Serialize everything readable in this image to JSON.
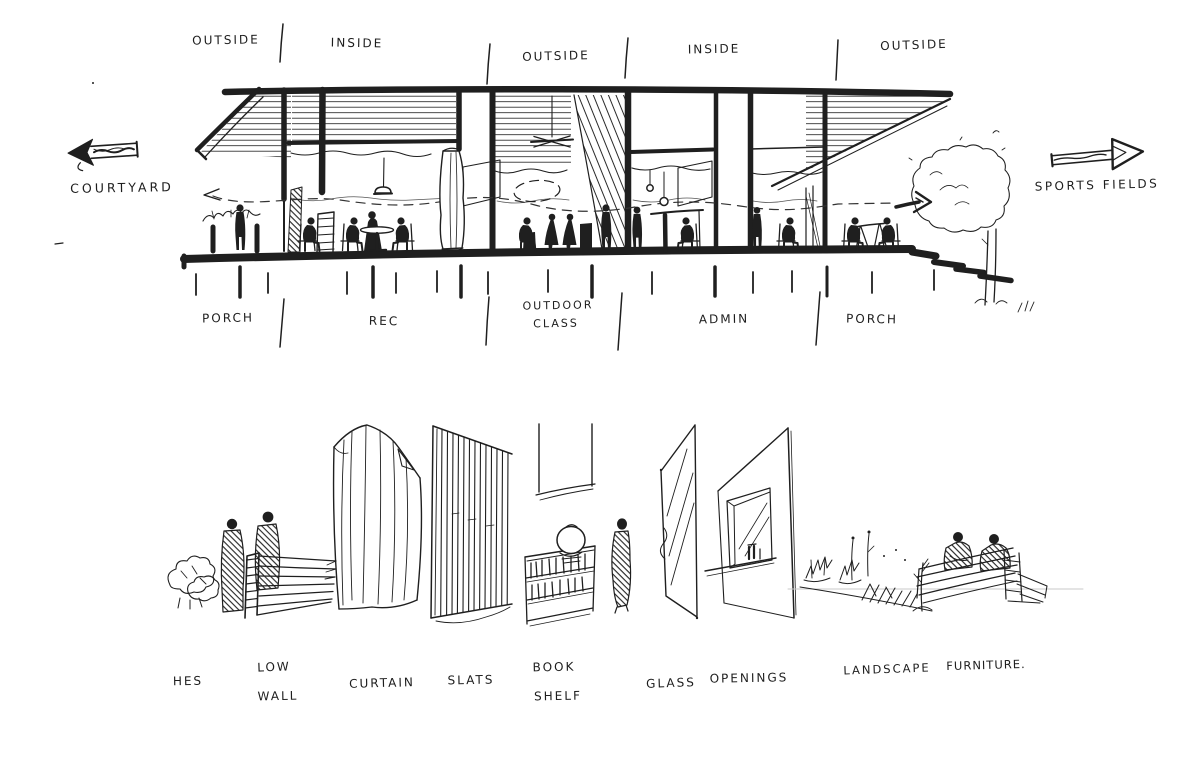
{
  "page": {
    "paper_color": "#ffffff",
    "ink_color": "#1f1f1f"
  },
  "icons": {
    "courtyard_arrow": "thick-arrow-left",
    "sports_fields_arrow": "thick-arrow-right",
    "sight_line_left": "dashed-arrow-left",
    "sight_line_right": "bold-arrow-right"
  },
  "section": {
    "zones": [
      {
        "label": "OUTSIDE"
      },
      {
        "label": "INSIDE"
      },
      {
        "label": "OUTSIDE"
      },
      {
        "label": "INSIDE"
      },
      {
        "label": "OUTSIDE"
      }
    ],
    "courtyard_label": "COURTYARD",
    "sports_fields_label": "SPORTS FIELDS",
    "rooms": [
      {
        "label": "PORCH"
      },
      {
        "label": "REC"
      },
      {
        "line1": "OUTDOOR",
        "line2": "CLASS"
      },
      {
        "label": "ADMIN"
      },
      {
        "label": "PORCH"
      }
    ]
  },
  "legend": {
    "hedges": "HES",
    "low_wall_1": "LOW",
    "low_wall_2": "WALL",
    "curtain": "CURTAIN",
    "slats": "SLATS",
    "bookshelf_1": "BOOK",
    "bookshelf_2": "SHELF",
    "glass": "GLASS",
    "openings": "OPENINGS",
    "landscape": "LANDSCAPE",
    "furniture": "FURNITURE."
  }
}
